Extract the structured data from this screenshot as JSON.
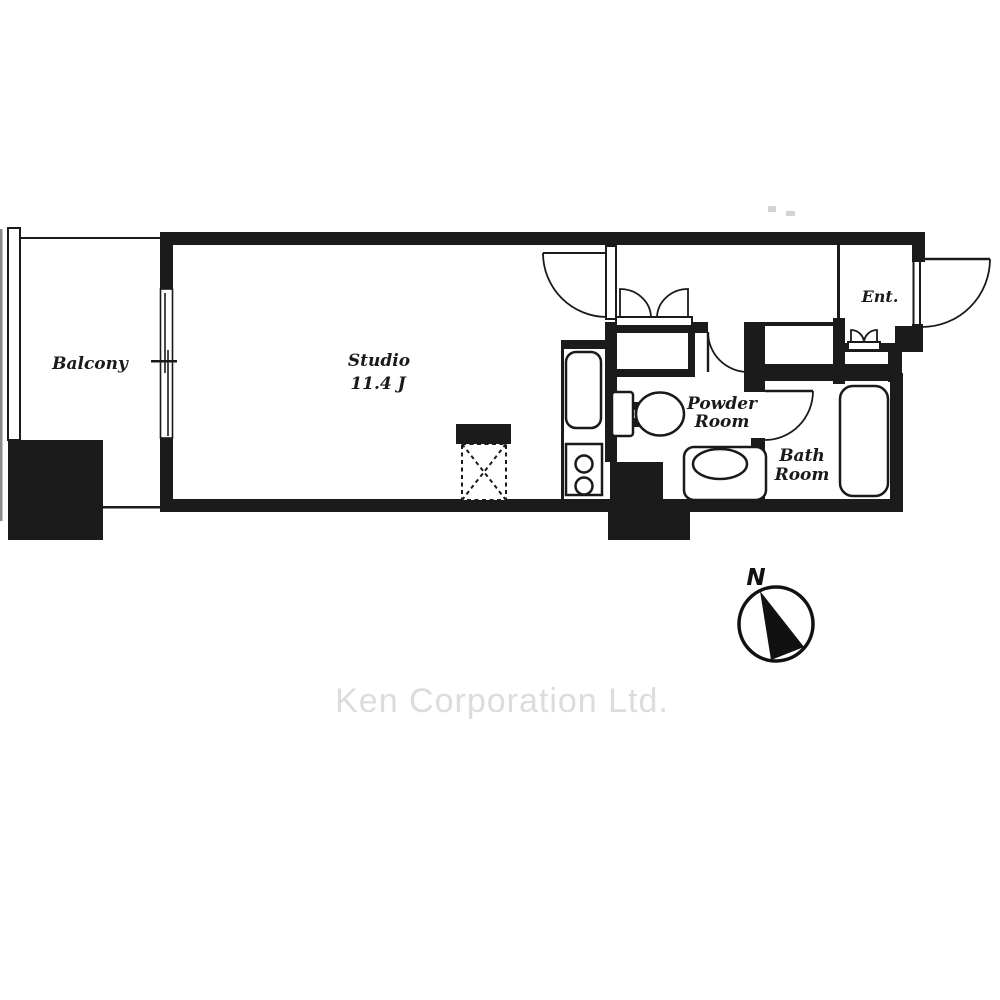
{
  "rooms": {
    "balcony": {
      "label": "Balcony"
    },
    "studio": {
      "label": "Studio",
      "area": "11.4 J"
    },
    "powder_room": {
      "line1": "Powder",
      "line2": "Room"
    },
    "bath_room": {
      "line1": "Bath",
      "line2": "Room"
    },
    "entrance": {
      "label": "Ent."
    }
  },
  "compass": {
    "north_label": "N"
  },
  "watermark": {
    "text": "Ken Corporation Ltd."
  },
  "colors": {
    "wall": "#1b1b1b",
    "line": "#1a1a1a",
    "background": "#ffffff",
    "watermark": "#dcdcdc"
  }
}
